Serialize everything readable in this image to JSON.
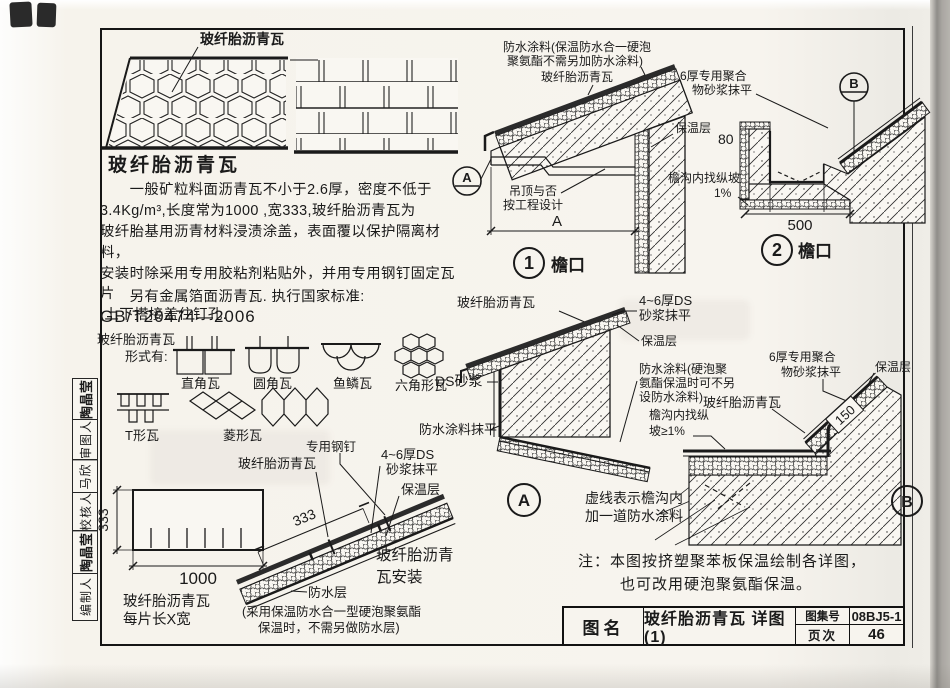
{
  "sidebar": [
    "陶晶莹",
    "审图人",
    "马欣",
    "校核人",
    "陶晶莹",
    "编制人"
  ],
  "intro": {
    "label": "玻纤胎沥青瓦",
    "heading": "玻纤胎沥青瓦",
    "para": "　　一般矿粒料面沥青瓦不小于2.6厚，密度不低于\n3.4Kg/m³,长度常为1000 ,宽333,玻纤胎沥青瓦为\n玻纤胎基用沥青材料浸渍涂盖，表面覆以保护隔离材料，\n安装时除采用专用胶粘剂粘贴外，并用专用钢钉固定瓦片\n,上下搭接盖住钉孔.",
    "para2": "　　另有金属箔面沥青瓦. 执行国家标准:",
    "standard": "GB/T20474—2006"
  },
  "forms": {
    "l1": "玻纤胎沥青瓦",
    "l2": "形式有:",
    "t1": "直角瓦",
    "t2": "圆角瓦",
    "t3": "鱼鳞瓦",
    "t4": "六角形瓦",
    "t5": "T形瓦",
    "t6": "菱形瓦"
  },
  "piece": {
    "h": "333",
    "w": "1000",
    "c1": "玻纤胎沥青瓦",
    "c2": "每片长X宽"
  },
  "install": {
    "nail": "专用钢钉",
    "shingle": "玻纤胎沥青瓦",
    "m1": "4~6厚DS",
    "m2": "砂浆抹平",
    "ins": "保温层",
    "dim": "333",
    "wp": "防水层",
    "note1": "(采用保温防水合一型硬泡聚氨酯",
    "note2": "保温时，不需另做防水层)",
    "cap1": "玻纤胎沥青",
    "cap2": "瓦安装"
  },
  "d1": {
    "c1": "防水涂料(保温防水合一硬泡",
    "c2": "聚氨酯不需另加防水涂料)",
    "shingle": "玻纤胎沥青瓦",
    "ins": "保温层",
    "marker": "A",
    "ceil1": "吊顶与否",
    "ceil2": "按工程设计",
    "dim": "A",
    "num": "1",
    "cap": "檐口"
  },
  "d2": {
    "m1": "6厚专用聚合",
    "m2": "物砂浆抹平",
    "marker": "B",
    "d80": "80",
    "slope1": "檐沟内找纵坡",
    "slope2": "1%",
    "d500": "500",
    "num": "2",
    "cap": "檐口"
  },
  "da": {
    "shingle": "玻纤胎沥青瓦",
    "m1": "4~6厚DS",
    "m2": "砂浆抹平",
    "ins": "保温层",
    "c1": "防水涂料(硬泡聚",
    "c2": "氨酯保温时可不另",
    "c3": "设防水涂料)",
    "ds": "DS砂浆",
    "mp": "防水涂料抹平",
    "marker": "A",
    "dash1": "虚线表示檐沟内",
    "dash2": "加一道防水涂料"
  },
  "db": {
    "m1": "6厚专用聚合",
    "m2": "物砂浆抹平",
    "ins": "保温层",
    "shingle": "玻纤胎沥青瓦",
    "slope1": "檐沟内找纵",
    "slope2": "坡≥1%",
    "d150": "150",
    "marker": "B"
  },
  "note": {
    "l1": "注：本图按挤塑聚苯板保温绘制各详图，",
    "l2": "也可改用硬泡聚氨酯保温。"
  },
  "tb": {
    "name": "图名",
    "title": "玻纤胎沥青瓦 详图(1)",
    "al": "图集号",
    "av": "08BJ5-1",
    "pl": "页次",
    "pv": "46"
  }
}
